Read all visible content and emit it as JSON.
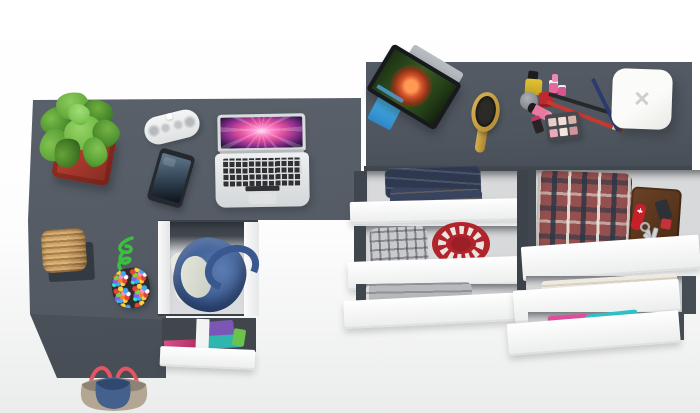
{
  "scene": {
    "type": "3d-product-render",
    "view": "top-down",
    "description": "Top-down render of a gray L-shaped desk and matching dresser with open white-front drawers filled with clothes and personal items",
    "background": "#ffffff"
  },
  "palette": {
    "desk_surface": "#58606a",
    "dresser_surface": "#4f565f",
    "furniture_edge": "#434a52",
    "drawer_front": "#fafbfb",
    "drawer_interior": "#d8d9db",
    "drawer_wall": "#454b53"
  },
  "desk": {
    "name": "L-shaped desk",
    "items_on_top": [
      {
        "name": "potted-plant",
        "pot_color": "#a83a2e",
        "foliage_color": "#5aa335"
      },
      {
        "name": "bluetooth-speaker",
        "color": "#f1f2f3"
      },
      {
        "name": "smartphone",
        "body_color": "#26292d",
        "screen_color": "#3a4c5e"
      },
      {
        "name": "laptop",
        "body_color": "#dfe1e3",
        "wallpaper": "pink-purple aurora",
        "key_color": "#2f3134"
      },
      {
        "name": "wicker-basket",
        "color": "#c2955b",
        "mat_color": "#343a41"
      },
      {
        "name": "beaded-pouch",
        "rope_color": "#38c13e",
        "bead_colors": [
          "#e8423c",
          "#3fa9f5",
          "#ffd23f",
          "#7ad53a",
          "#ff8ac2",
          "#8a5cf6",
          "#ff7f27",
          "#2ee6c8"
        ]
      }
    ],
    "drawers": [
      {
        "name": "large-open-drawer",
        "contents": [
          "denim-bag",
          "white-linen"
        ]
      },
      {
        "name": "small-open-drawer",
        "contents": [
          "purple-shirt",
          "teal-shirt",
          "green-cloth",
          "magenta-cloth"
        ]
      }
    ],
    "floor_item": {
      "name": "handbag",
      "body_color": "#b3a693",
      "panel_color": "#44608c",
      "handle_color": "#e25563"
    }
  },
  "dresser": {
    "name": "chest-of-drawers",
    "items_on_top": [
      {
        "name": "tablet-on-stand",
        "screen": "movie scene with red-haired character",
        "cover_color": "#3aa0d8"
      },
      {
        "name": "hairbrush",
        "color": "#caa23c",
        "bristle_color": "#2c2a26"
      },
      {
        "name": "makeup-set",
        "items": [
          "nail-polish-yellow",
          "nail-polish-red",
          "nail-polish-pink",
          "cream-jar",
          "lipstick-pink",
          "lipstick-dark",
          "pencil-black",
          "pencil-red",
          "pencil-navy",
          "eyeshadow-palette"
        ],
        "palette_pan_colors": [
          "#e7cdc8",
          "#f3ded6",
          "#dab4ab",
          "#eba9b9",
          "#f2e6de",
          "#cf949d"
        ]
      },
      {
        "name": "white-square-device",
        "color": "#f7f7f5",
        "mark": "x-logo"
      }
    ],
    "left_drawers": [
      {
        "contents": [
          "folded-jeans"
        ]
      },
      {
        "contents": [
          "gray-plaid-scarf",
          "red-knit-hat"
        ]
      },
      {
        "contents": [
          "gray-folded-clothes"
        ]
      }
    ],
    "right_drawers": [
      {
        "contents": [
          "plaid-shirt",
          "leather-wallet",
          "pocket-knife",
          "keys",
          "car-key-fob",
          "red-key-tag"
        ]
      },
      {
        "contents": [
          "white-towel"
        ]
      },
      {
        "contents": [
          "colorful-clothes"
        ]
      }
    ]
  }
}
